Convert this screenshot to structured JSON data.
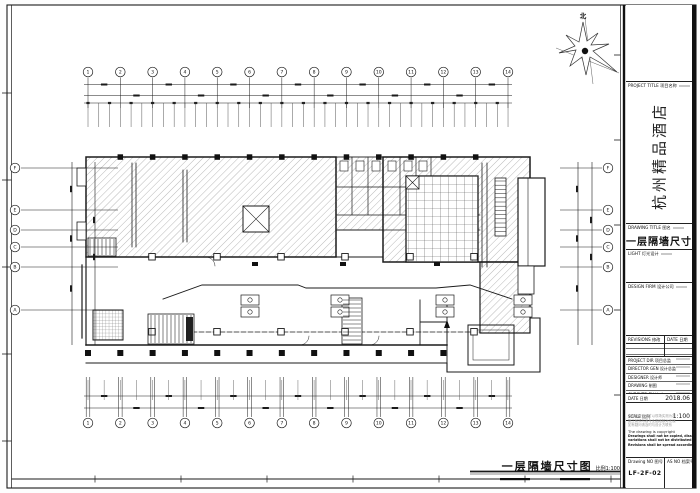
{
  "sheet": {
    "north_label": "北",
    "footer": {
      "drawing_title": "一层隔墙尺寸图",
      "scale_note": "比例1:100"
    }
  },
  "grid": {
    "top_columns": [
      "1",
      "2",
      "3",
      "4",
      "5",
      "6",
      "7",
      "8",
      "9",
      "10",
      "11",
      "12",
      "13",
      "14"
    ],
    "bottom_columns": [
      "1",
      "2",
      "3",
      "4",
      "5",
      "6",
      "7",
      "8",
      "9",
      "10",
      "11",
      "12",
      "13",
      "14"
    ],
    "left_rows": [
      "F",
      "E",
      "D",
      "C",
      "B",
      "A"
    ],
    "right_rows": [
      "F",
      "E",
      "D",
      "C",
      "B",
      "A"
    ]
  },
  "title_block": {
    "project_title_label": "PROJECT TITLE 项目名称",
    "project_title": "杭州精品酒店",
    "drawing_title_label": "DRAWING TITLE 图名",
    "drawing_title": "一层隔墙尺寸图",
    "light_label": "LIGHT 灯光设计",
    "design_firm_label": "DESIGN FIRM 设计公司",
    "revisions_label": "REVISIONS 修改",
    "revisions_date_label": "DATE 日期",
    "project_dir_label": "PROJECT DIR 项目总监",
    "director_label": "DIRECTOR GEN 设计总监",
    "designer_label": "DESIGNER 设计师",
    "drawing_label": "DRAWING 制图",
    "checked_label": "CHECKED BY 校对",
    "date_label": "DATE 日期",
    "date_value": "2018.06",
    "scale_label": "SCALE 比例",
    "scale_value": "1:100",
    "notes": [
      "本图纸所注尺寸以现场实测为准",
      "施工前须与各专业图纸核对无误",
      "如有疑问请及时与设计方联系",
      "The drawing is copyright",
      "Drawings shall not be copied, dissemination any",
      "variations shall not be distributed on site",
      "Revisions shall be spread according to issue"
    ],
    "drawing_no_label": "Drawing NO 图号",
    "drawing_no_value": "LF-2F-02",
    "as_no_label": "AS NO 档案号"
  }
}
